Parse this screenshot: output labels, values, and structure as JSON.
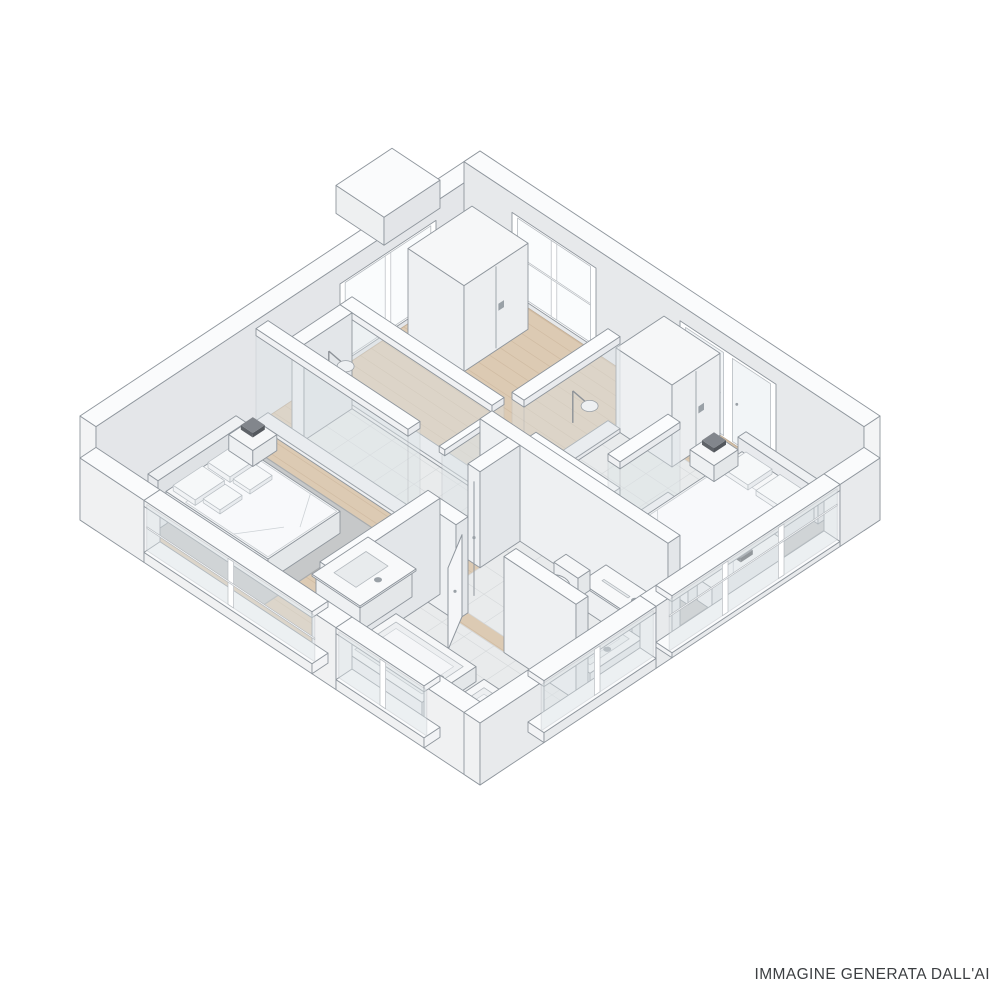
{
  "canvas": {
    "width": 1000,
    "height": 1000,
    "background": "#ffffff"
  },
  "caption": {
    "text": "IMMAGINE GENERATA DALL'AI",
    "color": "#3c3f42"
  },
  "palette": {
    "outline": "#8f969d",
    "outline_light": "#b7bcc1",
    "wall_top": "#fafbfc",
    "wall_ny": "#eef0f2",
    "wall_px": "#e3e6e9",
    "back_inner_right": "#e4e6e9",
    "back_inner_left": "#e7e9eb",
    "ext_left": "#f0f1f2",
    "ext_right": "#e8eaec",
    "jamb": "#f2f3f5",
    "floor_wood": "#dccab3",
    "floor_wood_line": "#c6b096",
    "tile": "#e9ebec",
    "tile_line": "#d4d7d9",
    "rug": "#c6c8c9",
    "rug_edge": "#a9acae",
    "glass": "#dde4e7",
    "glass_bright": "#fafcfd",
    "metal": "#9aa1a7",
    "lamp_dark": "#5f6368",
    "furn_top": "#f6f7f8",
    "furn_ny": "#eef0f2",
    "furn_px": "#e4e7e9"
  },
  "scene": {
    "type": "isometric-floor-plan",
    "style": "architectural 3d cutaway render, white model with wood floors",
    "rooms": [
      {
        "id": "bedroom-left",
        "label": "bedroom with double bed"
      },
      {
        "id": "entry-hall",
        "label": "hall with wardrobe"
      },
      {
        "id": "bedroom-right",
        "label": "bedroom with double bed"
      },
      {
        "id": "bathroom-left",
        "label": "bathroom with tub"
      },
      {
        "id": "bathroom-right",
        "label": "bathroom with toilet"
      },
      {
        "id": "shower-left",
        "label": "glass shower room"
      },
      {
        "id": "shower-right",
        "label": "glass shower room"
      }
    ],
    "furniture": [
      "double-bed",
      "nightstand",
      "table-lamp",
      "wardrobe",
      "tall-cabinet",
      "dresser",
      "bathtub",
      "shower-tray",
      "vanity-sink",
      "toilet",
      "shower-head",
      "interior-door",
      "rug"
    ],
    "windows": [
      "bedroom-left-window",
      "bathroom-left-window",
      "bedroom-right-glass-wall",
      "bathroom-right-window",
      "hall-sliding-window",
      "grid-window",
      "french-doors"
    ]
  }
}
